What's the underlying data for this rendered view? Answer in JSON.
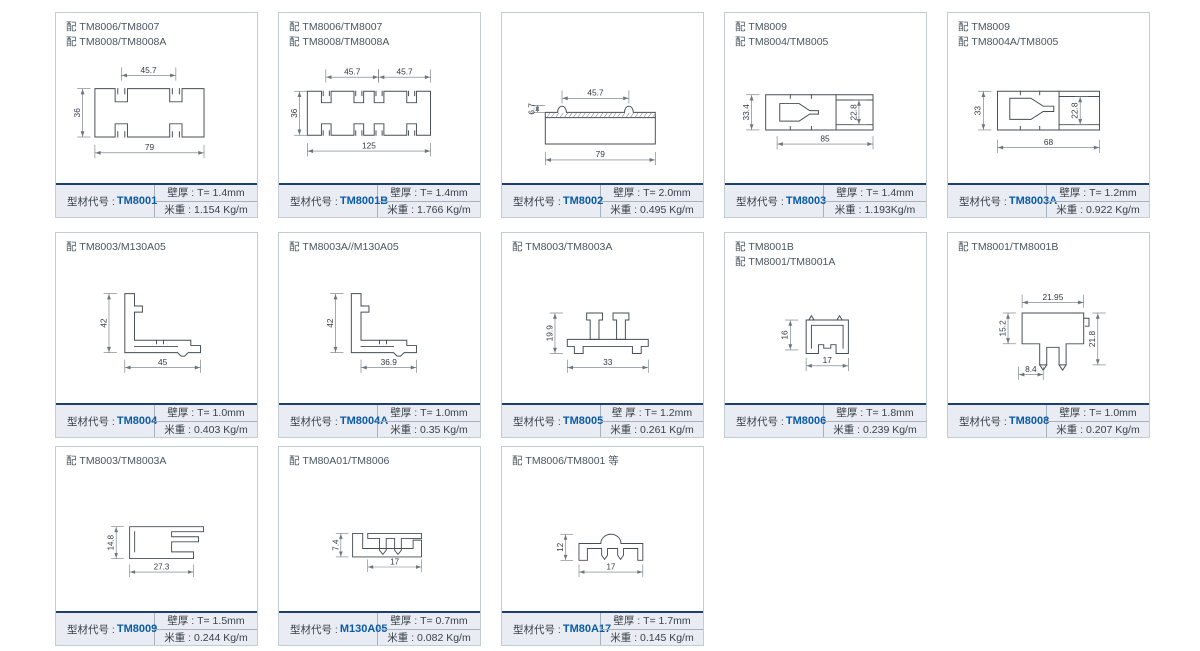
{
  "page": {
    "background": "#ffffff"
  },
  "colors": {
    "accent_blue": "#0a5aa8",
    "footer_line_navy": "#1d3f6e",
    "footer_bg": "#e9edf3",
    "card_border": "#c3cbd3",
    "drawing_stroke": "#464d54"
  },
  "footer_label": "型材代号 : ",
  "cards": [
    {
      "row": 0,
      "col": 0,
      "header": [
        "配 TM8006/TM8007",
        "配 TM8008/TM8008A"
      ],
      "code": "TM8001",
      "wall": "壁厚 : T=  1.4mm",
      "weight": "米重 : 1.154 Kg/m",
      "drawing": {
        "paths": [
          "M30,45 h23 v15 h14 v-15 h48 v15 h14 v-15 h25 v55 h-25 v-15 h-14 v15 h-48 v-15 h-14 v15 h-23 Z",
          "M56,45 v6 M64,45 v6 M118,45 v6 M126,45 v6 M56,100 v-6 M64,100 v-6 M118,100 v-6 M126,100 v-6"
        ],
        "dims": [
          {
            "o": "h",
            "label": "45.7",
            "a": 60,
            "b": 122,
            "c": 30
          },
          {
            "o": "v",
            "label": "36",
            "a": 45,
            "b": 100,
            "c": 16
          },
          {
            "o": "h",
            "label": "79",
            "a": 30,
            "b": 154,
            "c": 118
          }
        ]
      }
    },
    {
      "row": 0,
      "col": 1,
      "header": [
        "配 TM8006/TM8007",
        "配 TM8008/TM8008A"
      ],
      "code": "TM8001B",
      "wall": "壁厚 : T=  1.4mm",
      "weight": "米重 : 1.766 Kg/m",
      "drawing": {
        "paths": [
          "M18,48 h16 v13 h11 v-13 h26 v13 h11 v-13 h12 v13 h11 v-13 h26 v13 h11 v-13 h16 v50 h-16 v-13 h-11 v13 h-26 v-13 h-11 v13 h-12 v-13 h-11 v13 h-26 v-13 h-11 v13 h-16 Z",
          "M36,48 v5 M43,48 v5 M73,48 v5 M80,48 v5 M96,48 v5 M103,48 v5 M133,48 v5 M140,48 v5 M36,98 v-5 M43,98 v-5 M73,98 v-5 M80,98 v-5 M96,98 v-5 M103,98 v-5 M133,98 v-5 M140,98 v-5"
        ],
        "dims": [
          {
            "o": "h",
            "label": "45.7",
            "a": 39,
            "b": 99,
            "c": 32
          },
          {
            "o": "h",
            "label": "45.7",
            "a": 99,
            "b": 158,
            "c": 32
          },
          {
            "o": "v",
            "label": "36",
            "a": 48,
            "b": 98,
            "c": 9
          },
          {
            "o": "h",
            "label": "125",
            "a": 18,
            "b": 158,
            "c": 116
          }
        ]
      }
    },
    {
      "row": 0,
      "col": 2,
      "header": [],
      "code": "TM8002",
      "wall": "壁厚 : T=  2.0mm",
      "weight": "米重 : 0.495 Kg/m",
      "drawing": {
        "paths": [
          "M35,78 h125 v30 h-125 Z",
          "M35,78 v-6 h14 a5,7 0 0 1 10,0 h66 a5,7 0 0 1 10,0 h25 v6"
        ],
        "hatch": {
          "x1": 37,
          "x2": 158,
          "y1": 72.5,
          "y2": 77.5,
          "step": 5
        },
        "dims": [
          {
            "o": "v",
            "label": "6.7",
            "a": 64,
            "b": 72,
            "c": 26
          },
          {
            "o": "h",
            "label": "45.7",
            "a": 54,
            "b": 130,
            "c": 56
          },
          {
            "o": "h",
            "label": "79",
            "a": 35,
            "b": 160,
            "c": 126
          }
        ]
      }
    },
    {
      "row": 0,
      "col": 3,
      "header": [
        "配 TM8009",
        "配 TM8004/TM8005"
      ],
      "code": "TM8003",
      "wall": "壁厚 : T=  1.4mm",
      "weight": "米重 : 1.193Kg/m",
      "drawing": {
        "paths": [
          "M32,52 h122 v40 h-122 Z",
          "M112,52 v40",
          "M112,58 h42 M112,86 h42",
          "M48,62 h22 l12,8 h10 v4 h-10 l-12,8 h-22 Z",
          "M60,52 v4 M84,52 v4 M60,92 v-4 M84,92 v-4"
        ],
        "dims": [
          {
            "o": "v",
            "label": "33.4",
            "a": 52,
            "b": 92,
            "c": 16
          },
          {
            "o": "v",
            "label": "22.8",
            "a": 58,
            "b": 86,
            "c": 138
          },
          {
            "o": "h",
            "label": "85",
            "a": 45,
            "b": 154,
            "c": 108
          }
        ]
      }
    },
    {
      "row": 0,
      "col": 4,
      "header": [
        "配 TM8009",
        "配 TM8004A/TM8005"
      ],
      "code": "TM8003A",
      "wall": "壁厚 : T=  1.2mm",
      "weight": "米重 : 0.922 Kg/m",
      "drawing": {
        "paths": [
          "M42,48 h116 v44 h-116 Z",
          "M112,48 v44",
          "M112,54 h46 M112,86 h46",
          "M56,56 h24 l14,9 h12 v6 h-12 l-14,9 h-24 Z",
          "M68,48 v4 M90,48 v4 M68,92 v-4 M90,92 v-4"
        ],
        "dims": [
          {
            "o": "v",
            "label": "33",
            "a": 48,
            "b": 92,
            "c": 26
          },
          {
            "o": "v",
            "label": "22.8",
            "a": 54,
            "b": 86,
            "c": 136
          },
          {
            "o": "h",
            "label": "68",
            "a": 42,
            "b": 158,
            "c": 112
          }
        ]
      }
    },
    {
      "row": 1,
      "col": 0,
      "header": [
        "配 TM8003/M130A05"
      ],
      "code": "TM8004",
      "wall": "壁厚 : T=  1.0mm",
      "weight": "米重 : 0.403 Kg/m",
      "drawing": {
        "paths": [
          "M64,28 h11 v14 h9 v7 h-9 v32 h64 v6 h11 v8 h-14 l-4,4 h-4 l-4,-4 h-60 Z",
          "M75,88 h49 M100,81 v4 M108,81 v4"
        ],
        "dims": [
          {
            "o": "v",
            "label": "42",
            "a": 28,
            "b": 95,
            "c": 46
          },
          {
            "o": "h",
            "label": "45",
            "a": 64,
            "b": 150,
            "c": 112
          }
        ]
      }
    },
    {
      "row": 1,
      "col": 1,
      "header": [
        "配 TM8003A//M130A05"
      ],
      "code": "TM8004A",
      "wall": "壁厚 : T=  1.0mm",
      "weight": "米重 : 0.35 Kg/m",
      "drawing": {
        "paths": [
          "M68,28 h11 v14 h9 v7 h-9 v32 h52 v6 h11 v8 h-14 l-4,4 h-4 l-4,-4 h-48 Z",
          "M79,88 h37 M100,81 v4 M108,81 v4"
        ],
        "dims": [
          {
            "o": "v",
            "label": "42",
            "a": 28,
            "b": 95,
            "c": 50
          },
          {
            "o": "h",
            "label": "36.9",
            "a": 79,
            "b": 142,
            "c": 112
          }
        ]
      }
    },
    {
      "row": 1,
      "col": 2,
      "header": [
        "配 TM8003/TM8003A"
      ],
      "code": "TM8005",
      "wall": "壁  厚 : T=  1.2mm",
      "weight": "米重 : 0.261 Kg/m",
      "drawing": {
        "paths": [
          "M82,50 h18 v8 h-4 v22 h-10 v-22 h-4 Z",
          "M112,50 h18 v8 h-4 v22 h-10 v-22 h-4 Z",
          "M60,80 h92 v8 h-8 v8 h-10 v-8 h-56 v8 h-10 v-8 h-8 Z"
        ],
        "dims": [
          {
            "o": "v",
            "label": "19.9",
            "a": 50,
            "b": 96,
            "c": 46
          },
          {
            "o": "h",
            "label": "33",
            "a": 60,
            "b": 152,
            "c": 112
          }
        ]
      }
    },
    {
      "row": 1,
      "col": 3,
      "header": [
        "配 TM8001B",
        "配 TM8001/TM8001A"
      ],
      "code": "TM8006",
      "wall": "壁厚 : T=  1.8mm",
      "weight": "米重 : 0.239 Kg/m",
      "drawing": {
        "paths": [
          "M78,58 h48 v38 h-14 v-10 h-6 v4 h-8 v-4 h-6 v10 h-14 Z",
          "M84,90 v-26 h36 v26",
          "M81,58 l3,-5 l3,5 M113,58 l3,-5 l3,5"
        ],
        "dims": [
          {
            "o": "v",
            "label": "16",
            "a": 58,
            "b": 92,
            "c": 60
          },
          {
            "o": "h",
            "label": "17",
            "a": 78,
            "b": 126,
            "c": 110
          }
        ]
      }
    },
    {
      "row": 1,
      "col": 4,
      "header": [
        "配 TM8001/TM8001B"
      ],
      "code": "TM8008",
      "wall": "壁厚 : T=  1.0mm",
      "weight": "米重 : 0.207 Kg/m",
      "drawing": {
        "paths": [
          "M70,50 h70 v35 h-20 v24 h-8 v-20 h-14 v20 h-8 v-24 h-20 Z",
          "M140,56 h6 v9 h-4",
          "M90,109 l4,6 l4,-6 M112,109 l4,6 l4,-6"
        ],
        "dims": [
          {
            "o": "h",
            "label": "21.95",
            "a": 70,
            "b": 140,
            "c": 38
          },
          {
            "o": "v",
            "label": "15.2",
            "a": 50,
            "b": 85,
            "c": 54
          },
          {
            "o": "v",
            "label": "21.8",
            "a": 50,
            "b": 109,
            "c": 156
          },
          {
            "o": "h",
            "label": "8.4",
            "a": 66,
            "b": 94,
            "c": 120
          }
        ]
      }
    },
    {
      "row": 2,
      "col": 0,
      "header": [
        "配 TM8003/TM8003A"
      ],
      "code": "TM8009",
      "wall": "壁厚 : T=  1.5mm",
      "weight": "米重 : 0.244 Kg/m",
      "drawing": {
        "paths": [
          "M68,52 h88 v6 h-38 v6 h32 v6 h-32 v12 h26 v8 h-76 Z",
          "M74,58 v24"
        ],
        "dims": [
          {
            "o": "v",
            "label": "14.8",
            "a": 52,
            "b": 90,
            "c": 52
          },
          {
            "o": "h",
            "label": "27.3",
            "a": 68,
            "b": 144,
            "c": 106
          }
        ]
      }
    },
    {
      "row": 2,
      "col": 1,
      "header": [
        "配 TM80A01/TM8006"
      ],
      "code": "M130A05",
      "wall": "壁厚 : T=  0.7mm",
      "weight": "米重 : 0.082 Kg/m",
      "drawing": {
        "paths": [
          "M68,60 h12 v18 h60 v-10 h10 v20 h-82 Z",
          "M86,60 h64 v6 h-24 v14 l-4,5 l-4,-5 v-14 h-10 v14 l-4,5 l-4,-5 v-14 h-14 Z"
        ],
        "dims": [
          {
            "o": "v",
            "label": "7.4",
            "a": 60,
            "b": 88,
            "c": 54
          },
          {
            "o": "h",
            "label": "17",
            "a": 86,
            "b": 150,
            "c": 100
          }
        ]
      }
    },
    {
      "row": 2,
      "col": 2,
      "header": [
        "配 TM8006/TM8001 等"
      ],
      "code": "TM80A17",
      "wall": "壁厚 : T=  1.7mm",
      "weight": "米重 : 0.145 Kg/m",
      "drawing": {
        "paths": [
          "M72,92 v-20 h26 a12,11 0 0 1 24,0 h26 v20 h-6 v-14 h-17 v8 l-3.5,5 l-3.5,-5 v-8 h-12 v8 l-3.5,5 l-3.5,-5 v-8 h-17 v14 Z"
        ],
        "dims": [
          {
            "o": "v",
            "label": "12",
            "a": 61,
            "b": 92,
            "c": 56
          },
          {
            "o": "h",
            "label": "17",
            "a": 72,
            "b": 148,
            "c": 106
          }
        ]
      }
    }
  ]
}
